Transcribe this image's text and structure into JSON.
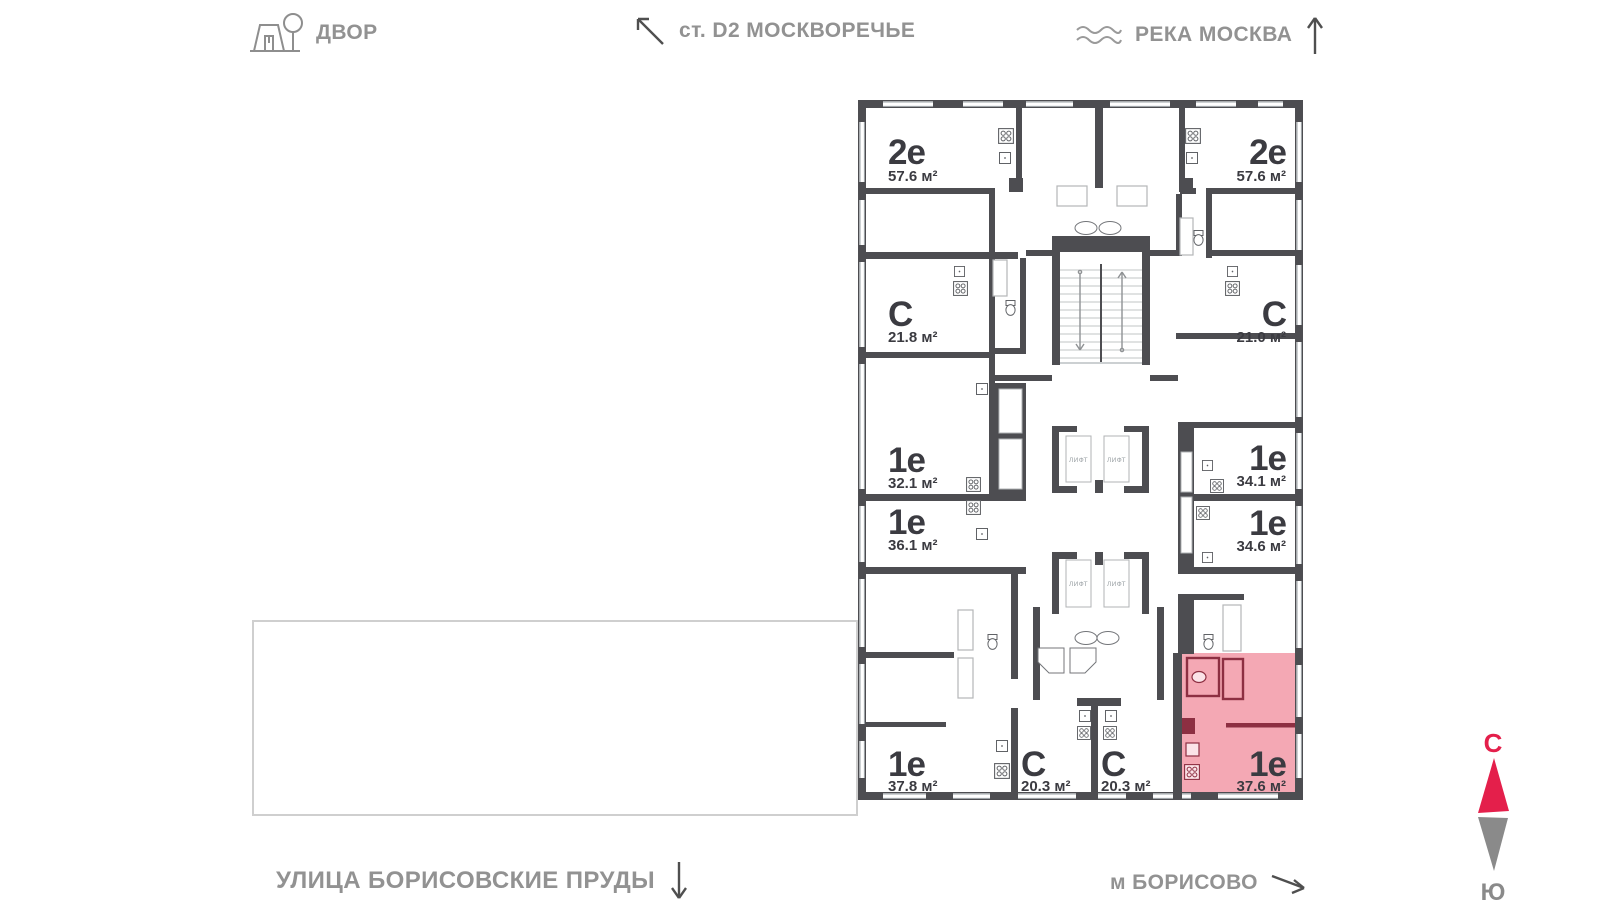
{
  "nav": {
    "yard_label": "ДВОР",
    "station_label": "ст. D2 МОСКВОРЕЧЬЕ",
    "river_label": "РЕКА МОСКВА",
    "street_label": "УЛИЦА БОРИСОВСКИЕ ПРУДЫ",
    "metro_label": "м БОРИСОВО"
  },
  "compass": {
    "north_label": "С",
    "south_label": "Ю"
  },
  "colors": {
    "accent_red": "#e41f4b",
    "selected_fill": "#f4a8b4",
    "selected_wall": "#8d2f42",
    "wall": "#4d4d51",
    "label_text": "#3b3b41",
    "nav_text": "#929292"
  },
  "plan": {
    "elevator_label": "ЛИФТ",
    "apartments": [
      {
        "id": "left-2e",
        "type": "2е",
        "area": "57.6 м²",
        "selected": false
      },
      {
        "id": "left-s-21-8",
        "type": "С",
        "area": "21.8 м²",
        "selected": false
      },
      {
        "id": "left-1e-32-1",
        "type": "1е",
        "area": "32.1 м²",
        "selected": false
      },
      {
        "id": "left-1e-36-1",
        "type": "1е",
        "area": "36.1 м²",
        "selected": false
      },
      {
        "id": "left-1e-37-8",
        "type": "1е",
        "area": "37.8 м²",
        "selected": false
      },
      {
        "id": "center-s-20-3-a",
        "type": "С",
        "area": "20.3 м²",
        "selected": false
      },
      {
        "id": "center-s-20-3-b",
        "type": "С",
        "area": "20.3 м²",
        "selected": false
      },
      {
        "id": "right-1e-37-6",
        "type": "1е",
        "area": "37.6 м²",
        "selected": true
      },
      {
        "id": "right-1e-34-6",
        "type": "1е",
        "area": "34.6 м²",
        "selected": false
      },
      {
        "id": "right-1e-34-1",
        "type": "1е",
        "area": "34.1 м²",
        "selected": false
      },
      {
        "id": "right-s-21-0",
        "type": "С",
        "area": "21.0 м²",
        "selected": false
      },
      {
        "id": "right-2e",
        "type": "2е",
        "area": "57.6 м²",
        "selected": false
      }
    ]
  }
}
